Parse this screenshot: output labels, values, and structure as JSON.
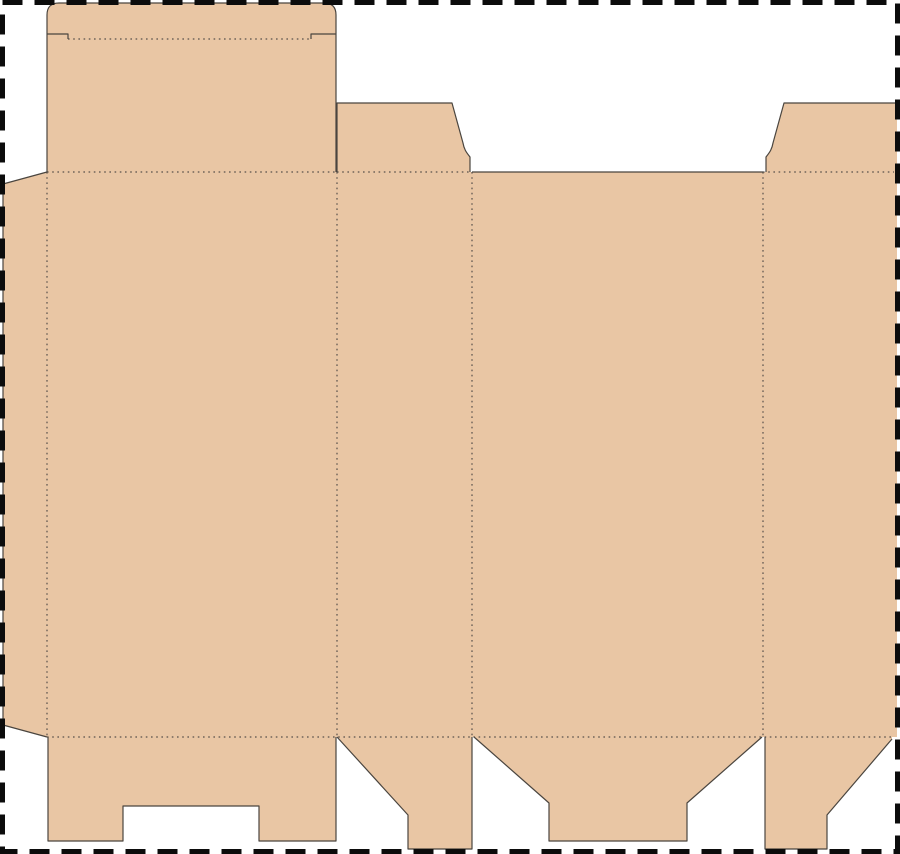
{
  "diagram": {
    "title": "Folding carton box dieline template",
    "type": "packaging-dieline",
    "canvas": {
      "width": 900,
      "height": 854,
      "background": "#ffffff"
    },
    "border": {
      "color": "#0c0c0c",
      "stroke_width": 5,
      "dash_pattern": "20 12",
      "inset": 2.5
    },
    "styles": {
      "board_fill": "#e9c6a4",
      "cut_color": "#4a453f",
      "cut_width": 1.2,
      "fold_color": "#57504a",
      "fold_width": 1.2,
      "fold_dash": "1.6 3.6"
    },
    "pieces": [
      {
        "name": "glue-flap",
        "path": "M47,172 L3,184 L3,725 L47,737 Z"
      },
      {
        "name": "body-panels",
        "path": "M47,172 H897 V737 H47 Z"
      },
      {
        "name": "tuck-lid",
        "path": "M47,172 V15 Q47,3 59,3 H324 Q336,3 336,15 V172 Z"
      },
      {
        "name": "dust-flap-top-left",
        "path": "M337,172 V103 H452 L463,143 C464,149 466,152 470,157 V172 Z"
      },
      {
        "name": "dust-flap-top-right",
        "path": "M766,172 V157 C770,152 772,149 773,143 L784,103 H897 V172 Z"
      },
      {
        "name": "bottom-flap-front",
        "path": "M48,737 V841 H123 V806 H259 V841 H336 V737 Z"
      },
      {
        "name": "bottom-flap-left",
        "path": "M337,737 L408,815 V849 H472 V737 Z"
      },
      {
        "name": "bottom-flap-back",
        "path": "M474,737 L549,803 V841 H687 V803 L762,737 Z"
      },
      {
        "name": "bottom-flap-right",
        "path": "M765,737 V849 H827 V815 L892,739 V737 Z"
      }
    ],
    "cut_lines": [
      {
        "name": "glue-flap-cut",
        "path": "M47,172 L3,184 V725 L47,737"
      },
      {
        "name": "tuck-lid-cut",
        "path": "M47,172 V15 Q47,3 59,3 H324 Q336,3 336,15 V172"
      },
      {
        "name": "tuck-shoulder-slit-left",
        "path": "M47,34 H68 V39"
      },
      {
        "name": "tuck-shoulder-slit-right",
        "path": "M336,34 H311 V39"
      },
      {
        "name": "dust-flap-top-left-cut",
        "path": "M337,172 V103 H452 L463,143 C464,149 466,152 470,157 V172"
      },
      {
        "name": "back-panel-top-cut",
        "path": "M472,172 H763"
      },
      {
        "name": "dust-flap-top-right-cut",
        "path": "M766,172 V157 C770,152 772,149 773,143 L784,103 H897"
      },
      {
        "name": "bottom-flap-front-cut",
        "path": "M48,737 V841 H123 V806 H259 V841 H336 V737"
      },
      {
        "name": "bottom-flap-left-cut",
        "path": "M337,737 L408,815 V849 H472 V737"
      },
      {
        "name": "bottom-flap-back-cut",
        "path": "M474,737 L549,803 V841 H687 V803 L762,737"
      },
      {
        "name": "bottom-flap-right-cut",
        "path": "M765,737 V849 H827 V815 L892,739"
      }
    ],
    "fold_lines": [
      {
        "name": "tuck-tongue-fold",
        "path": "M68,39 H311"
      },
      {
        "name": "top-fold-front-panel",
        "path": "M47,172 H336"
      },
      {
        "name": "top-fold-left-panel",
        "path": "M337,172 H470"
      },
      {
        "name": "top-fold-right-panel",
        "path": "M763,172 H894"
      },
      {
        "name": "bottom-fold-main",
        "path": "M47,737 H892"
      },
      {
        "name": "vertical-fold-glue",
        "path": "M47,172 V737"
      },
      {
        "name": "vertical-fold-front-left",
        "path": "M337,172 V737"
      },
      {
        "name": "vertical-fold-left-back",
        "path": "M472,172 V737"
      },
      {
        "name": "vertical-fold-back-right",
        "path": "M763,172 V737"
      }
    ]
  }
}
